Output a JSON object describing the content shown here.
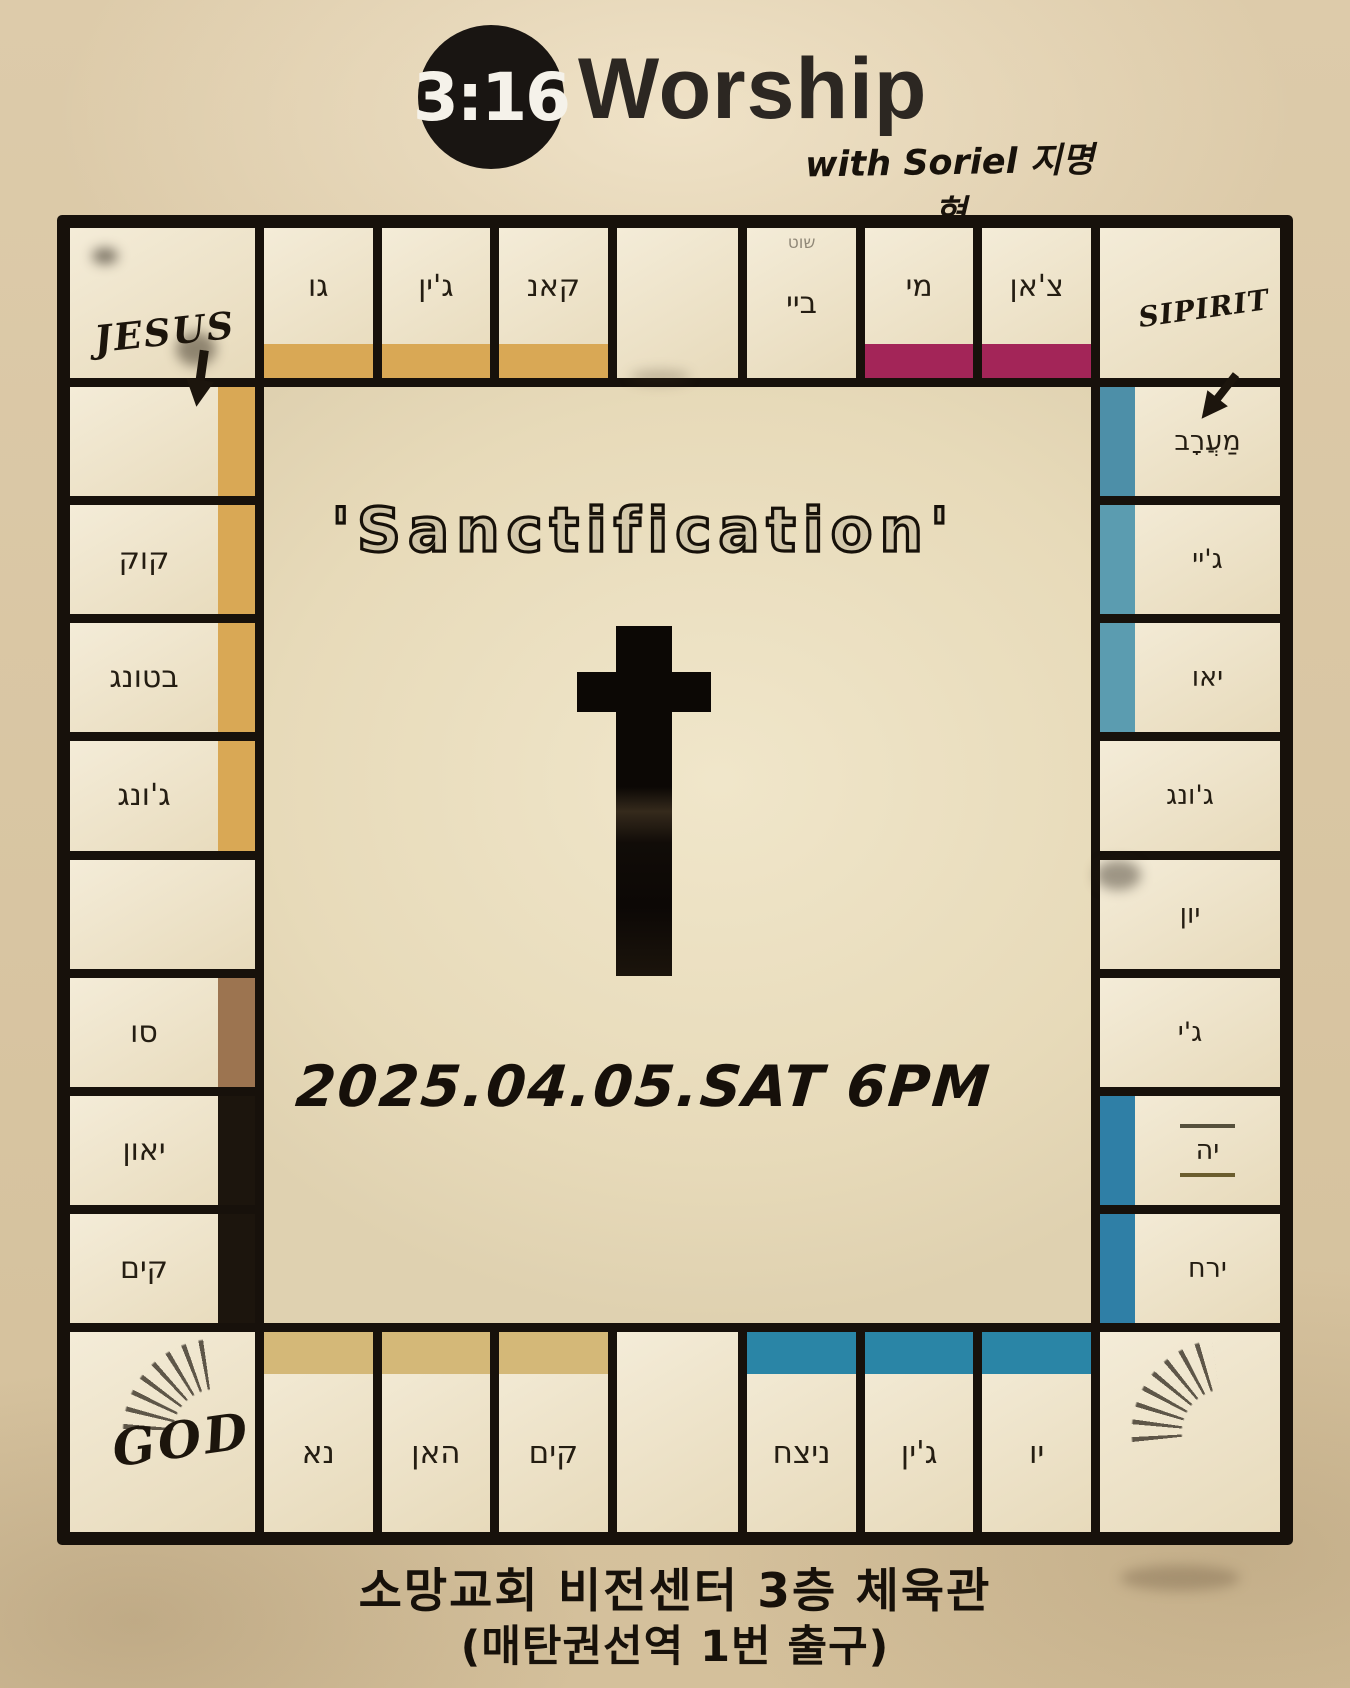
{
  "header": {
    "logo_badge": "3:16",
    "logo_word": "Worship",
    "tagline": "with Soriel 지명현"
  },
  "board": {
    "corners": {
      "top_left": "JESUS",
      "top_right": "SIPIRIT",
      "bottom_left": "GOD",
      "bottom_right": ""
    },
    "top_row": [
      {
        "label": "גו",
        "bar": "#d9a855"
      },
      {
        "label": "ג'ין",
        "bar": "#d9a855"
      },
      {
        "label": "קאנ",
        "bar": "#d9a855"
      },
      {
        "label": "",
        "bar": null,
        "wide": true
      },
      {
        "label": "ביי",
        "bar": null,
        "note": "שוט"
      },
      {
        "label": "מי",
        "bar": "#a32558"
      },
      {
        "label": "צ'אן",
        "bar": "#a32558"
      }
    ],
    "left_col": [
      {
        "label": "",
        "bar": "#d9a855"
      },
      {
        "label": "קוק",
        "bar": "#d9a855"
      },
      {
        "label": "בטונג",
        "bar": "#d9a855"
      },
      {
        "label": "ג'ונג",
        "bar": "#d9a855"
      },
      {
        "label": "",
        "bar": null
      },
      {
        "label": "סו",
        "bar": "#9c7450"
      },
      {
        "label": "יאון",
        "bar": "#1c150d"
      },
      {
        "label": "קים",
        "bar": "#1c150d"
      }
    ],
    "right_col": [
      {
        "label": "מַעֲרָב",
        "bar": "#4d8fa8"
      },
      {
        "label": "ג'יי",
        "bar": "#5b9cb0"
      },
      {
        "label": "יאו",
        "bar": "#5b9cb0"
      },
      {
        "label": "ג'ונג",
        "bar": null
      },
      {
        "label": "יון",
        "bar": null
      },
      {
        "label": "ג'י",
        "bar": null
      },
      {
        "label": "יה",
        "bar": "#2f7fa6",
        "lines": true
      },
      {
        "label": "ירח",
        "bar": "#2f7fa6"
      }
    ],
    "bottom_row": [
      {
        "label": "נא",
        "bar": "#d4b878"
      },
      {
        "label": "האן",
        "bar": "#d4b878"
      },
      {
        "label": "קים",
        "bar": "#d4b878"
      },
      {
        "label": "",
        "bar": null,
        "wide": true
      },
      {
        "label": "ניצח",
        "bar": "#2a85a6"
      },
      {
        "label": "ג'ין",
        "bar": "#2a85a6"
      },
      {
        "label": "יו",
        "bar": "#2a85a6"
      }
    ],
    "center": {
      "title": "'Sanctification'",
      "datetime": "2025.04.05.SAT 6PM"
    }
  },
  "footer": {
    "line1": "소망교회 비전센터 3층 체육관",
    "line2": "(매탄권선역 1번 출구)"
  },
  "colors": {
    "board_line": "#17110b",
    "paper": "#efe6d0",
    "page_background": "#d8c6a4",
    "orange_bar": "#d9a855",
    "magenta_bar": "#a32558",
    "blue_bar": "#5b9cb0",
    "teal_bar": "#2a85a6",
    "khaki_bar": "#d4b878",
    "brown_bar": "#9c7450",
    "black_bar": "#1c150d"
  }
}
